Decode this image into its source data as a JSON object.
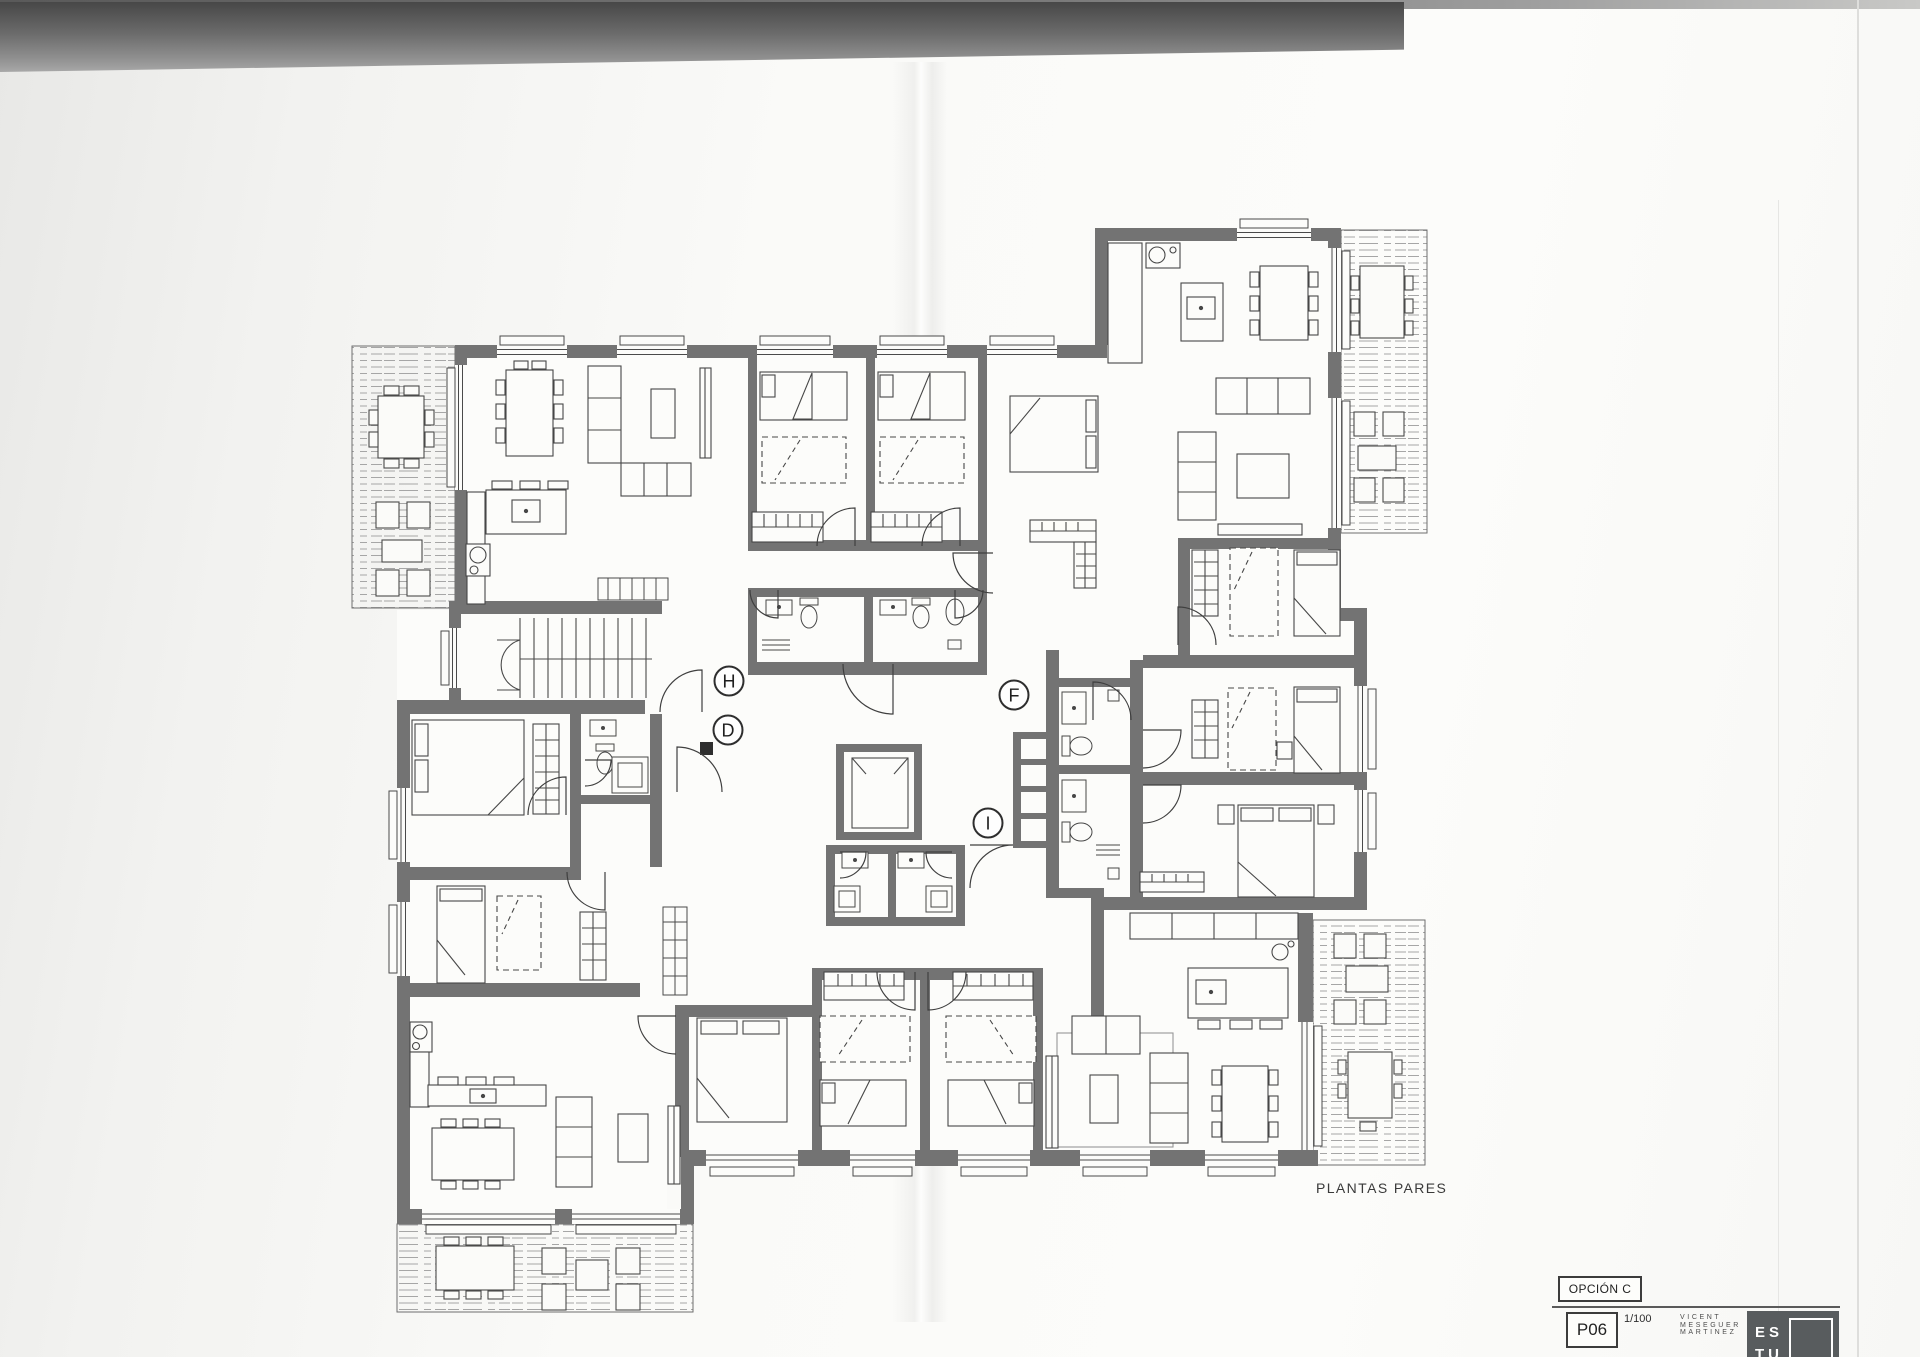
{
  "document": {
    "caption": "PLANTAS PARES"
  },
  "plan": {
    "markers": [
      {
        "letter": "H"
      },
      {
        "letter": "D"
      },
      {
        "letter": "F"
      },
      {
        "letter": "I"
      }
    ]
  },
  "title_block": {
    "option": "OPCIÓN C",
    "sheet": "P06",
    "scale": "1/100",
    "architect": [
      "VICENT",
      "MESEGUER",
      "MARTINEZ"
    ],
    "logo": [
      "ES",
      "TU"
    ]
  },
  "colors": {
    "wall": "#737373",
    "scan_band": "#474747",
    "logo_background": "#585c5e"
  }
}
